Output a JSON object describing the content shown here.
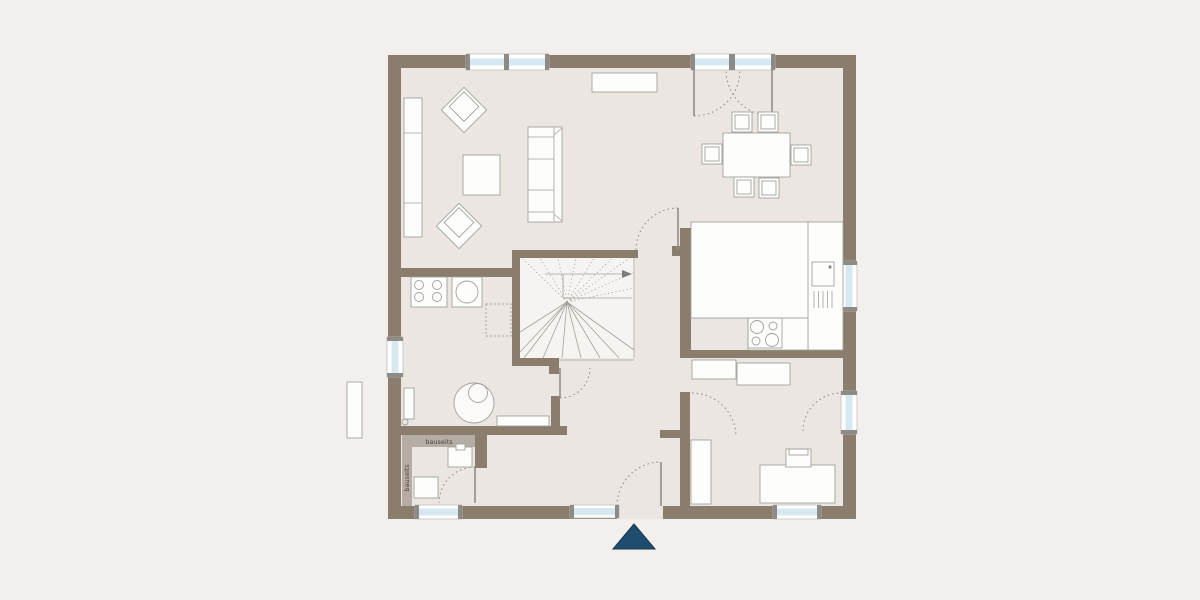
{
  "title": "ground-floor-plan",
  "labels": {
    "bauseits_top": "bauseits",
    "bauseits_left": "bauseits"
  },
  "colors": {
    "bg": "#f2efec",
    "floor": "#ebe6e2",
    "wall": "#8a7d6e",
    "band": "#b5aca3",
    "glaze": "#d7e8f0",
    "furn": "#fdfdfc",
    "line": "#a3a19c",
    "swing": "#8c8c8a",
    "marker": "#1e4d70"
  },
  "symbols": [
    "window",
    "french-door",
    "entrance-door-with-sidelight",
    "door-swing-arc",
    "winder-staircase",
    "sofa",
    "armchair",
    "coffee-table",
    "shelf-unit",
    "sideboard",
    "dining-table",
    "dining-chair",
    "kitchen-counter",
    "kitchen-sink",
    "cooktop",
    "washer",
    "washing-machine",
    "boiler",
    "radiator",
    "wc-sink",
    "shower-tray",
    "wardrobe-cabinet",
    "desk",
    "desk-chair",
    "entrance-marker"
  ]
}
